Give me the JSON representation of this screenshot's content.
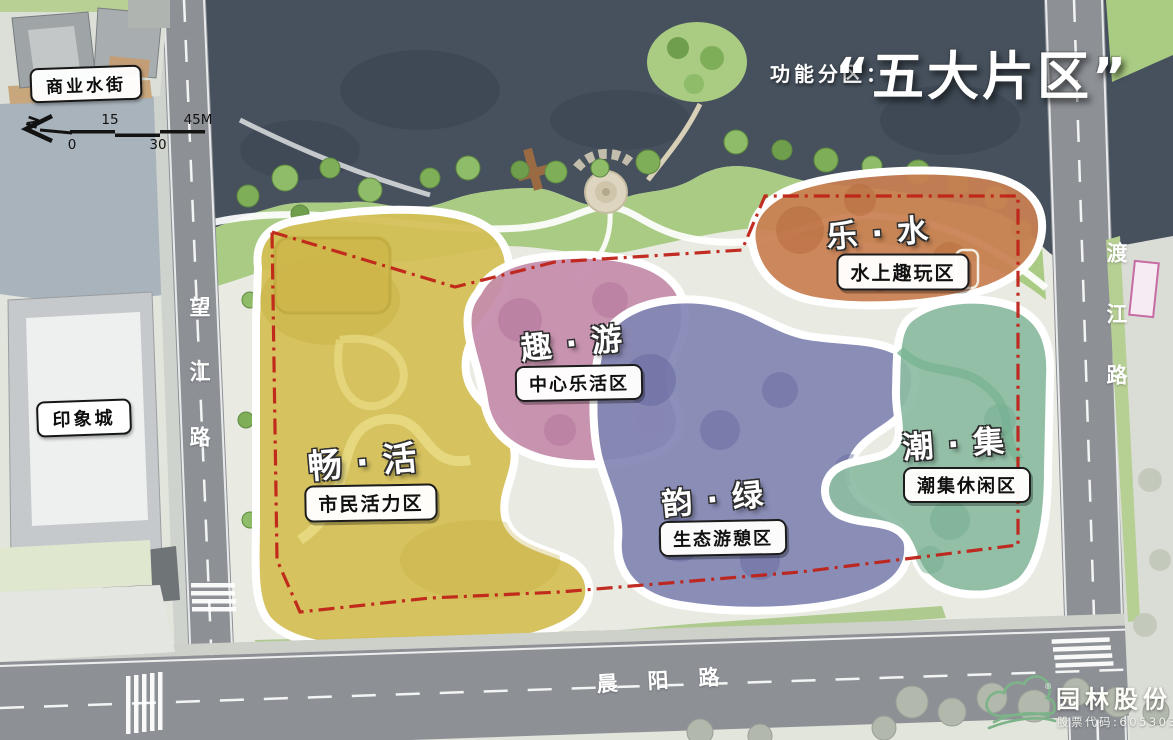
{
  "title": {
    "prefix": "功能分区：",
    "main": "“五大片区”"
  },
  "landmarks": {
    "water_street": "商业水街",
    "mall": "印象城"
  },
  "roads": {
    "west": "望江路",
    "east": "渡江路",
    "south": "晨阳路"
  },
  "scalebar": {
    "north": "N",
    "t0": "0",
    "t15": "15",
    "t30": "30",
    "t45": "45M"
  },
  "zones": [
    {
      "key": "chang-huo",
      "name": "畅·活",
      "label": "市民活力区",
      "color": "#d4be55"
    },
    {
      "key": "qu-you",
      "name": "趣·游",
      "label": "中心乐活区",
      "color": "#c58cab"
    },
    {
      "key": "le-shui",
      "name": "乐·水",
      "label": "水上趣玩区",
      "color": "#c97f52"
    },
    {
      "key": "yun-lv",
      "name": "韵·绿",
      "label": "生态游憩区",
      "color": "#8287b4"
    },
    {
      "key": "chao-ji",
      "name": "潮·集",
      "label": "潮集休闲区",
      "color": "#8dbba2"
    }
  ],
  "logo": {
    "company": "园林股份",
    "stock": "股票代码:605303",
    "reg": "®"
  }
}
